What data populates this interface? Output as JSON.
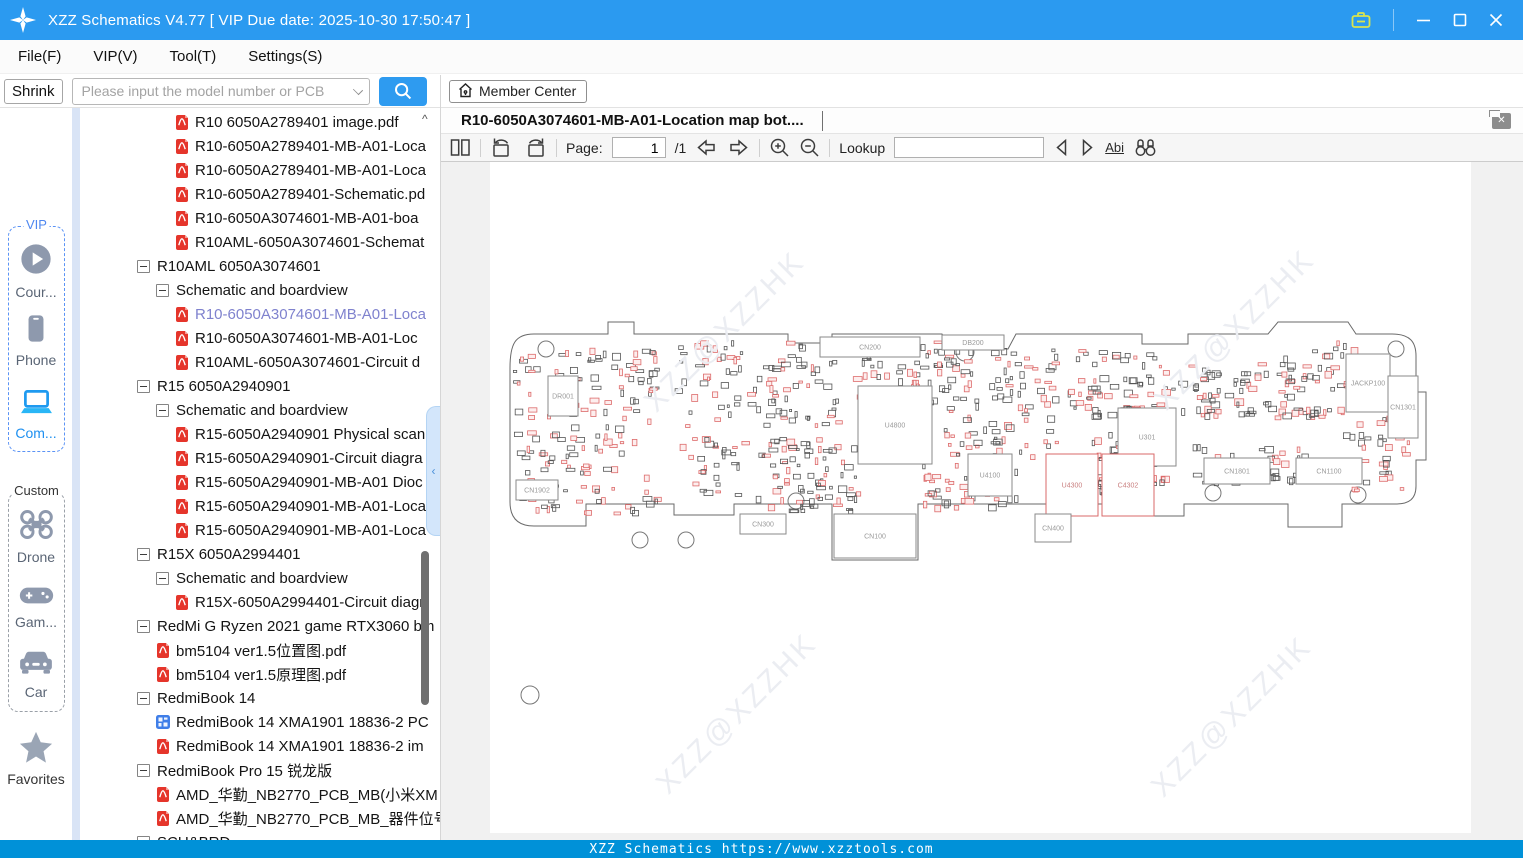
{
  "window": {
    "title": "XZZ Schematics V4.77 [ VIP Due date: 2025-10-30 17:50:47 ]"
  },
  "menu": {
    "items": [
      {
        "name": "file",
        "label": "File(F)"
      },
      {
        "name": "vip",
        "label": "VIP(V)"
      },
      {
        "name": "tool",
        "label": "Tool(T)"
      },
      {
        "name": "settings",
        "label": "Settings(S)"
      }
    ]
  },
  "search": {
    "shrink_label": "Shrink",
    "placeholder": "Please input the model number or PCB"
  },
  "member_center": {
    "label": "Member Center"
  },
  "sidebar": {
    "vip_group_label": "VIP",
    "custom_group_label": "Custom",
    "vip_items": [
      {
        "name": "courses",
        "label": "Cour...",
        "icon": "play-circle",
        "active": false
      },
      {
        "name": "phone",
        "label": "Phone",
        "icon": "phone",
        "active": false
      },
      {
        "name": "computer",
        "label": "Com...",
        "icon": "laptop",
        "active": true
      }
    ],
    "custom_items": [
      {
        "name": "drone",
        "label": "Drone",
        "icon": "drone",
        "active": false
      },
      {
        "name": "games",
        "label": "Gam...",
        "icon": "gamepad",
        "active": false
      },
      {
        "name": "car",
        "label": "Car",
        "icon": "car",
        "active": false
      }
    ],
    "favorites_label": "Favorites"
  },
  "tree": {
    "items": [
      {
        "kind": "pdf",
        "depth": 2,
        "label": "R10 6050A2789401 image.pdf"
      },
      {
        "kind": "pdf",
        "depth": 2,
        "label": "R10-6050A2789401-MB-A01-Loca"
      },
      {
        "kind": "pdf",
        "depth": 2,
        "label": "R10-6050A2789401-MB-A01-Loca"
      },
      {
        "kind": "pdf",
        "depth": 2,
        "label": "R10-6050A2789401-Schematic.pd"
      },
      {
        "kind": "pdf",
        "depth": 2,
        "label": "R10-6050A3074601-MB-A01-boa"
      },
      {
        "kind": "pdf",
        "depth": 2,
        "label": "R10AML-6050A3074601-Schemat"
      },
      {
        "kind": "group",
        "depth": 0,
        "label": "R10AML 6050A3074601"
      },
      {
        "kind": "group",
        "depth": 1,
        "label": "Schematic and boardview"
      },
      {
        "kind": "pdf",
        "depth": 2,
        "label": "R10-6050A3074601-MB-A01-Loca",
        "selected": true
      },
      {
        "kind": "pdf",
        "depth": 2,
        "label": "R10-6050A3074601-MB-A01-Loc"
      },
      {
        "kind": "pdf",
        "depth": 2,
        "label": "R10AML-6050A3074601-Circuit d"
      },
      {
        "kind": "group",
        "depth": 0,
        "label": "R15 6050A2940901"
      },
      {
        "kind": "group",
        "depth": 1,
        "label": "Schematic and boardview"
      },
      {
        "kind": "pdf",
        "depth": 2,
        "label": "R15-6050A2940901 Physical scan"
      },
      {
        "kind": "pdf",
        "depth": 2,
        "label": "R15-6050A2940901-Circuit diagra"
      },
      {
        "kind": "pdf",
        "depth": 2,
        "label": "R15-6050A2940901-MB-A01 Dioc"
      },
      {
        "kind": "pdf",
        "depth": 2,
        "label": "R15-6050A2940901-MB-A01-Loca"
      },
      {
        "kind": "pdf",
        "depth": 2,
        "label": "R15-6050A2940901-MB-A01-Loca"
      },
      {
        "kind": "group",
        "depth": 0,
        "label": "R15X 6050A2994401"
      },
      {
        "kind": "group",
        "depth": 1,
        "label": "Schematic and boardview"
      },
      {
        "kind": "pdf",
        "depth": 2,
        "label": "R15X-6050A2994401-Circuit diagr"
      },
      {
        "kind": "group",
        "depth": 0,
        "label": "RedMi G Ryzen 2021 game RTX3060 bm"
      },
      {
        "kind": "pdf",
        "depth": 1,
        "label": "bm5104 ver1.5位置图.pdf"
      },
      {
        "kind": "pdf",
        "depth": 1,
        "label": "bm5104 ver1.5原理图.pdf"
      },
      {
        "kind": "group",
        "depth": 0,
        "label": "RedmiBook 14"
      },
      {
        "kind": "board",
        "depth": 1,
        "label": "RedmiBook 14 XMA1901 18836-2 PC"
      },
      {
        "kind": "pdf",
        "depth": 1,
        "label": "RedmiBook 14 XMA1901 18836-2 im"
      },
      {
        "kind": "group",
        "depth": 0,
        "label": "RedmiBook Pro 15 锐龙版"
      },
      {
        "kind": "pdf",
        "depth": 1,
        "label": "AMD_华勤_NB2770_PCB_MB(小米XM"
      },
      {
        "kind": "pdf",
        "depth": 1,
        "label": "AMD_华勤_NB2770_PCB_MB_器件位号"
      },
      {
        "kind": "group",
        "depth": 0,
        "label": "SCU&BRD"
      }
    ]
  },
  "doc": {
    "tab_title": "R10-6050A3074601-MB-A01-Location map bot....",
    "toolbar": {
      "page_label": "Page:",
      "page_value": "1",
      "page_total": "/1",
      "lookup_label": "Lookup",
      "abi_label": "Abi"
    }
  },
  "viewer": {
    "watermark": "XZZ@XZZHK",
    "parts": [
      {
        "label": "DR001",
        "x": 58,
        "y": 214,
        "w": 30,
        "h": 40
      },
      {
        "label": "CN1902",
        "x": 26,
        "y": 318,
        "w": 42,
        "h": 20
      },
      {
        "label": "CN200",
        "x": 330,
        "y": 175,
        "w": 100,
        "h": 20
      },
      {
        "label": "DB200",
        "x": 452,
        "y": 173,
        "w": 62,
        "h": 15
      },
      {
        "label": "U4800",
        "x": 368,
        "y": 224,
        "w": 74,
        "h": 78
      },
      {
        "label": "U301",
        "x": 628,
        "y": 246,
        "w": 58,
        "h": 58
      },
      {
        "label": "U4300",
        "x": 556,
        "y": 292,
        "w": 52,
        "h": 62,
        "red": true
      },
      {
        "label": "C4302",
        "x": 612,
        "y": 292,
        "w": 52,
        "h": 62,
        "red": true
      },
      {
        "label": "U4100",
        "x": 478,
        "y": 292,
        "w": 44,
        "h": 42
      },
      {
        "label": "CN100",
        "x": 344,
        "y": 352,
        "w": 82,
        "h": 44
      },
      {
        "label": "CN300",
        "x": 250,
        "y": 352,
        "w": 46,
        "h": 20
      },
      {
        "label": "CN400",
        "x": 545,
        "y": 352,
        "w": 36,
        "h": 28
      },
      {
        "label": "CN1801",
        "x": 714,
        "y": 296,
        "w": 66,
        "h": 26
      },
      {
        "label": "CN1100",
        "x": 806,
        "y": 296,
        "w": 66,
        "h": 26
      },
      {
        "label": "JACKP100",
        "x": 856,
        "y": 192,
        "w": 44,
        "h": 58
      },
      {
        "label": "CN1301",
        "x": 898,
        "y": 214,
        "w": 30,
        "h": 62
      }
    ]
  },
  "statusbar": {
    "text": "XZZ Schematics https://www.xzztools.com"
  },
  "colors": {
    "titlebar": "#2b9af0",
    "statusbar": "#0091d8",
    "accent": "#2e9bf0",
    "selected_tree_item": "#7f82ce"
  }
}
